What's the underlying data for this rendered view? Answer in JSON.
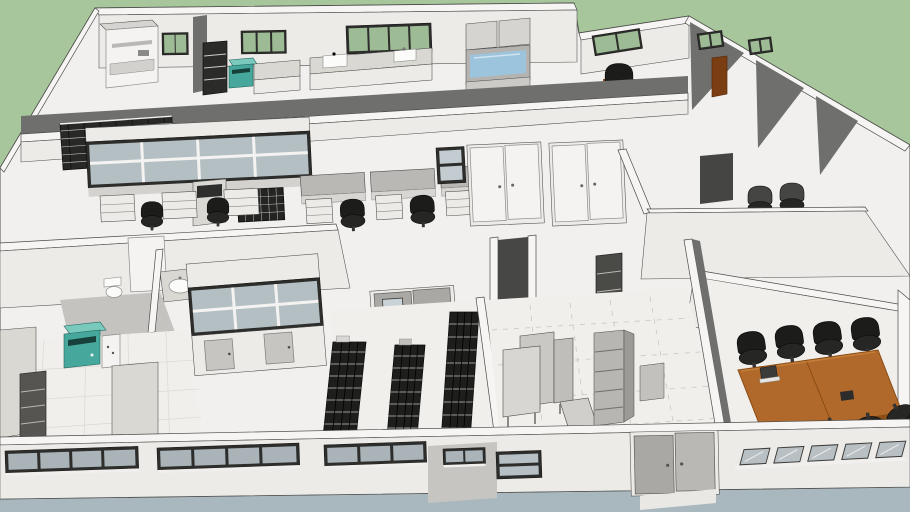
{
  "scene": {
    "description": "Isometric 3D model of an office and laboratory floor plan viewed from above",
    "background_color": "#a7c69b",
    "ground_color": "#a9b7bf",
    "palette": {
      "wall_top": "#f6f5f3",
      "wall_face": "#ecebe8",
      "wall_shade": "#6f6f6d",
      "floor": "#f0efec",
      "outline": "#4b4b49",
      "frame_dark": "#2d2d2b",
      "glass_green": "#9dbb95",
      "glass_blue": "#9cc5dd",
      "glass_gray": "#b4bfc3",
      "rack_black": "#1e1e1c",
      "chair_black": "#1c1c1a",
      "wood": "#b0692a",
      "wood_dark": "#8a4d15",
      "marble": "#d9d8d2",
      "teal": "#46a89c",
      "teal_light": "#79cabc",
      "door_gray": "#a9a8a5",
      "cabinet_gray": "#b7b6b3",
      "metal": "#d5d4d1",
      "arm_brown": "#8a4a1e"
    },
    "building": {
      "rooms": [
        {
          "name": "back-lab-left",
          "objects": [
            "copier-machine",
            "tall-dark-cabinet",
            "teal-analyzer",
            "marble-counter",
            "green-window"
          ]
        },
        {
          "name": "back-lab-center",
          "objects": [
            "sink-counter",
            "double-sink",
            "green-windows",
            "fume-hood-with-blue-glass"
          ]
        },
        {
          "name": "back-office-right",
          "objects": [
            "desk-chair-with-brown-arms",
            "green-windows",
            "wood-door"
          ]
        },
        {
          "name": "open-office",
          "objects": [
            "interior-window-wall",
            "lab-benches",
            "task-chairs",
            "storage-crate-rack",
            "wire-cage",
            "white-double-doors"
          ]
        },
        {
          "name": "right-offices",
          "objects": [
            "mesh-task-chairs",
            "dark-doorway"
          ]
        },
        {
          "name": "restroom",
          "objects": [
            "toilet",
            "vanity-sink",
            "white-door"
          ]
        },
        {
          "name": "break-room",
          "objects": [
            "marble-counters",
            "teal-coffee-machine",
            "tall-gray-cabinet",
            "tile-floor"
          ]
        },
        {
          "name": "storage-room",
          "objects": [
            "wire-shelving-rack",
            "wire-shelving-rack",
            "wire-shelving-rack",
            "gray-double-door-with-window"
          ]
        },
        {
          "name": "shipping-area",
          "objects": [
            "work-tables",
            "leaning-panel",
            "shelving-cabinet",
            "dashed-floor-markings"
          ]
        },
        {
          "name": "conference-room",
          "objects": [
            "wood-conference-table",
            "office-chairs",
            "laptop",
            "speakerphone"
          ]
        }
      ],
      "conference_chair_count": 9,
      "exterior": {
        "front_window_groups": 6,
        "entrance": "gray-double-door",
        "back_window_glass": "green-tinted"
      }
    }
  }
}
